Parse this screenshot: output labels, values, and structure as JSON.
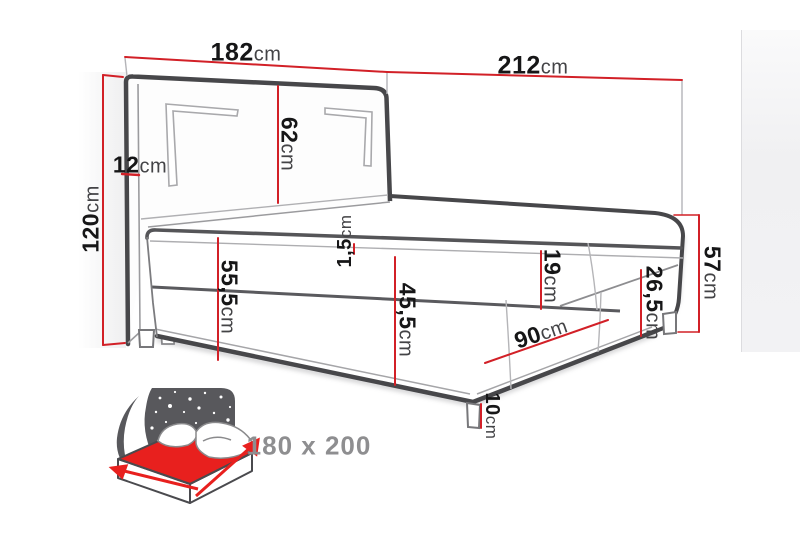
{
  "diagram": {
    "dimensions": {
      "headboard_width": {
        "value": "182",
        "unit": "cm"
      },
      "total_length": {
        "value": "212",
        "unit": "cm"
      },
      "headboard_height": {
        "value": "120",
        "unit": "cm"
      },
      "headboard_depth": {
        "value": "12",
        "unit": "cm"
      },
      "headboard_above_mattress": {
        "value": "62",
        "unit": "cm"
      },
      "height_no_topper": {
        "value": "55,5",
        "unit": "cm"
      },
      "topper_height": {
        "value": "1,5",
        "unit": "cm"
      },
      "mattress_plus_base": {
        "value": "45,5",
        "unit": "cm"
      },
      "mattress_height": {
        "value": "19",
        "unit": "cm"
      },
      "base_height": {
        "value": "26,5",
        "unit": "cm"
      },
      "leg_height": {
        "value": "10",
        "unit": "cm"
      },
      "base_section": {
        "value": "90",
        "unit": "cm"
      },
      "total_height": {
        "value": "57",
        "unit": "cm"
      }
    },
    "badge": {
      "size_label": "180 x 200"
    },
    "colors": {
      "dimension_red": "#d22027",
      "icon_mattress_red": "#e8201e",
      "outline_dark": "#4a4a4d",
      "badge_gray": "#8e8e90"
    }
  }
}
